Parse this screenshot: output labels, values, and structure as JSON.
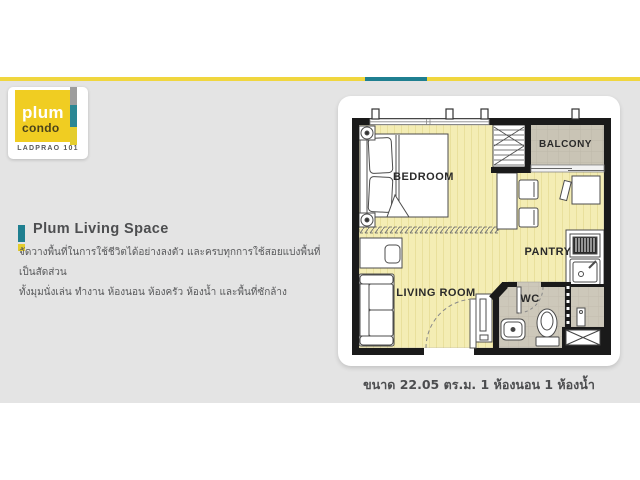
{
  "brand": {
    "name_top": "plum",
    "name_bottom": "condo",
    "subtitle": "LADPRAO 101"
  },
  "section": {
    "title": "Plum Living Space",
    "description_line1": "จัดวางพื้นที่ในการใช้ชีวิตได้อย่างลงตัว และครบทุกการใช้สอยแบ่งพื้นที่เป็นสัดส่วน",
    "description_line2": "ทั้งมุมนั่งเล่น ทำงาน ห้องนอน ห้องครัว ห้องน้ำ และพื้นที่ซักล้าง"
  },
  "floor_plan": {
    "labels": {
      "bedroom": "BEDROOM",
      "balcony": "BALCONY",
      "pantry": "PANTRY",
      "wc": "WC",
      "living_room": "LIVING ROOM"
    },
    "caption": "ขนาด 22.05 ตร.ม. 1 ห้องนอน 1 ห้องน้ำ"
  },
  "colors": {
    "accent_yellow": "#f0d63e",
    "accent_teal": "#1f7f90",
    "logo_yellow": "#f0cd22",
    "background_gray": "#e4e4e4",
    "floor_yellow": "#f4edb4",
    "balcony_gray": "#c9c4b5",
    "wc_gray": "#cdc8ba",
    "wall_black": "#1a1a1a"
  }
}
